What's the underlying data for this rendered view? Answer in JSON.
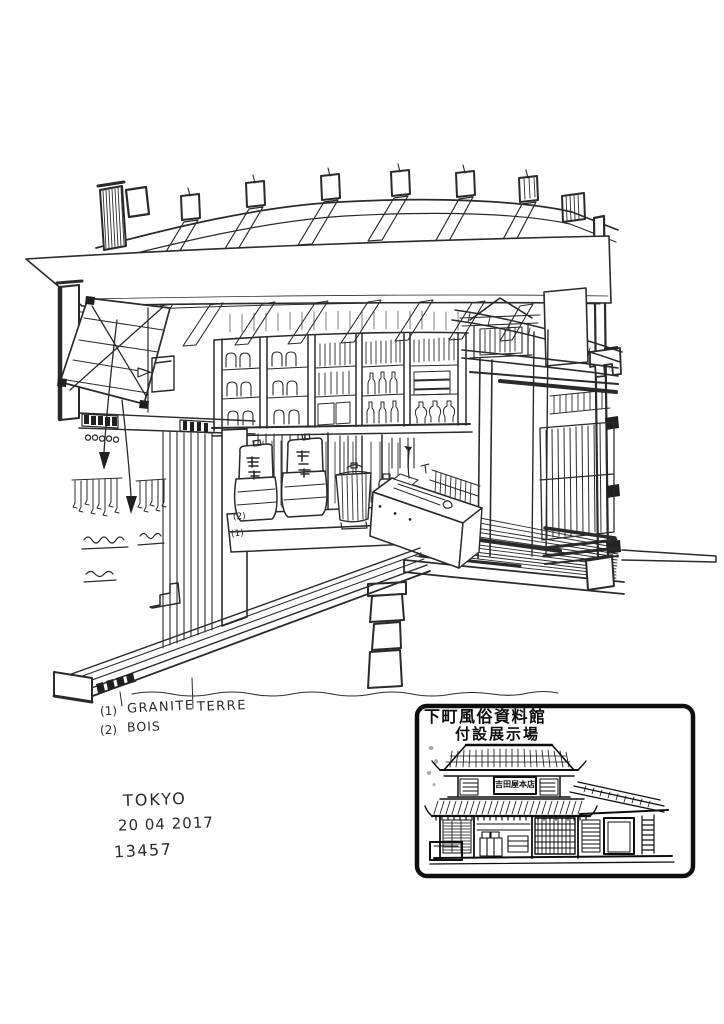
{
  "colors": {
    "paper": "#ffffff",
    "ink": "#2a2a2a",
    "stamp_ink": "#0e0e0e"
  },
  "annotations": {
    "materials": [
      {
        "index": "(1)",
        "label": "GRANITE"
      },
      {
        "index": "(2)",
        "label": "BOIS"
      }
    ],
    "ground_label": "TERRE",
    "platform_marks": [
      {
        "label": "(2)"
      },
      {
        "label": "(1)"
      }
    ]
  },
  "signature": {
    "city": "TOKYO",
    "date": "20 04 2017",
    "time": "13457"
  },
  "stamp": {
    "title_line1": "下町風俗資料館",
    "title_line2": "付設展示場",
    "building_sign": "吉田屋本店"
  }
}
